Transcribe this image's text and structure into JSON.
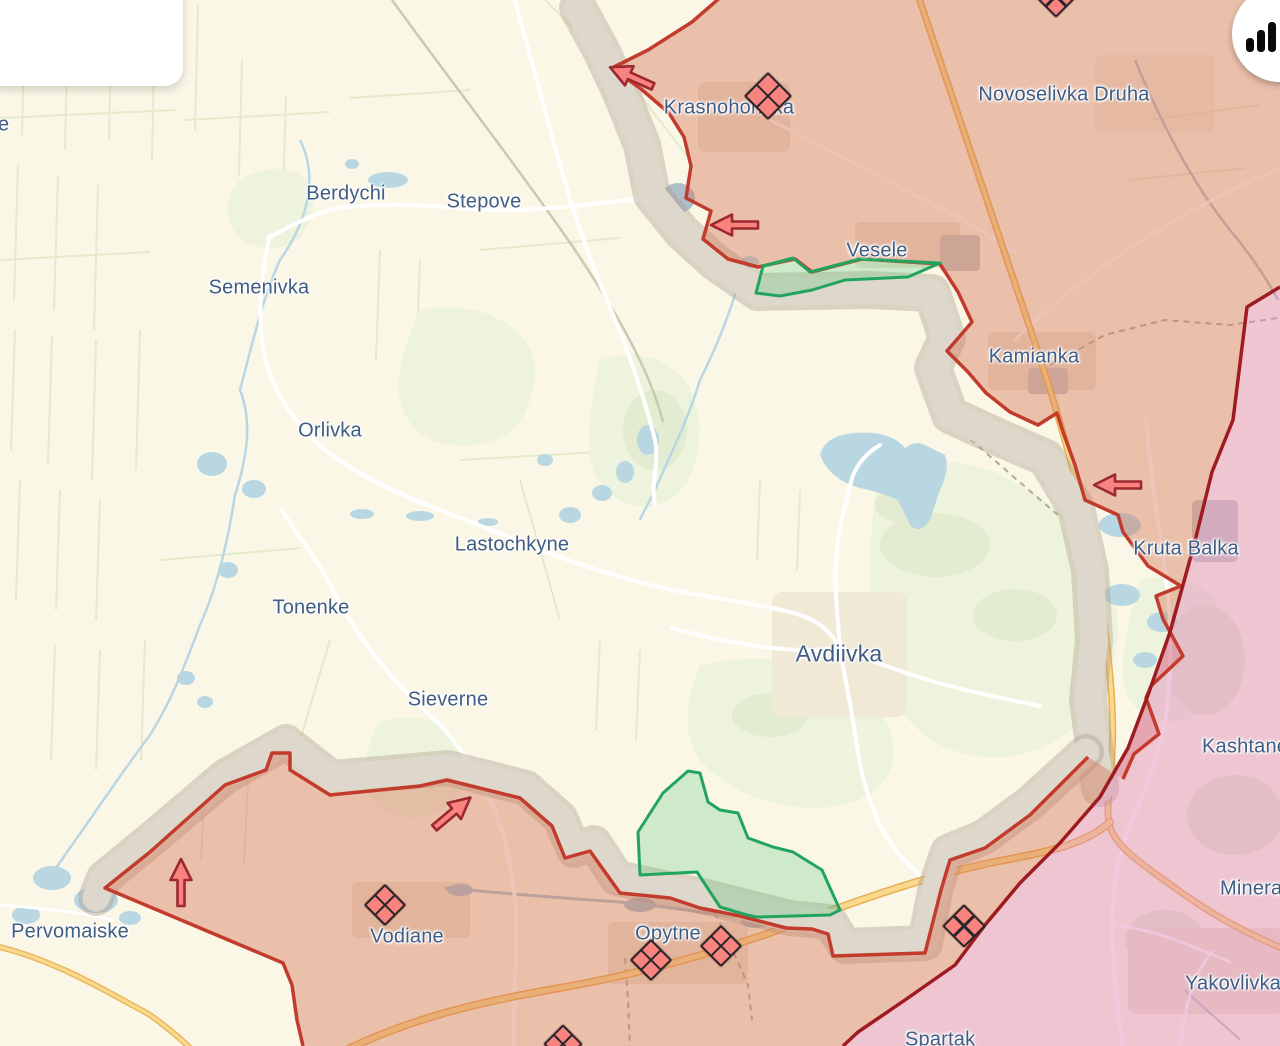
{
  "ui": {
    "info_card": {
      "note": "empty white popup card, content cut off at screen edge"
    },
    "stats_button": {
      "icon": "bar-chart-icon"
    }
  },
  "map": {
    "colors": {
      "background": "#fbf7e7",
      "field_line": "#dce7c1",
      "water": "#b9d7e2",
      "highway": "#f8d98d",
      "highway_casing": "#eaaf52",
      "occupied_fill": "rgba(213,116,88,0.42)",
      "occupied_2014_fill": "rgba(225,135,185,0.45)",
      "grey_zone_fill": "#ded7cb",
      "front_line": "#c23b2c",
      "pre2022_line": "#9e1b22",
      "liberated_stroke": "#21a55e",
      "liberated_fill": "rgba(76,195,119,0.25)",
      "town_label": "#3f5c84",
      "marker_fill": "#f9837e",
      "marker_outline": "#26262a",
      "arrow_outline": "#9c2830"
    },
    "town_labels": [
      {
        "text": "Berdychi",
        "x": 346,
        "y": 194,
        "size": 20
      },
      {
        "text": "Stepove",
        "x": 484,
        "y": 202,
        "size": 20
      },
      {
        "text": "Semenivka",
        "x": 259,
        "y": 288,
        "size": 20
      },
      {
        "text": "Orlivka",
        "x": 330,
        "y": 431,
        "size": 20
      },
      {
        "text": "Lastochkyne",
        "x": 512,
        "y": 545,
        "size": 20
      },
      {
        "text": "Tonenke",
        "x": 311,
        "y": 608,
        "size": 20
      },
      {
        "text": "Sieverne",
        "x": 448,
        "y": 700,
        "size": 20
      },
      {
        "text": "Avdiivka",
        "x": 839,
        "y": 654,
        "size": 23
      },
      {
        "text": "Krasnohorivka",
        "x": 729,
        "y": 108,
        "size": 20
      },
      {
        "text": "Novoselivka Druha",
        "x": 1064,
        "y": 95,
        "size": 20
      },
      {
        "text": "Vesele",
        "x": 877,
        "y": 251,
        "size": 20
      },
      {
        "text": "Kamianka",
        "x": 1034,
        "y": 357,
        "size": 20
      },
      {
        "text": "Kruta Balka",
        "x": 1186,
        "y": 549,
        "size": 20
      },
      {
        "text": "Pervomaiske",
        "x": 70,
        "y": 932,
        "size": 20
      },
      {
        "text": "Vodiane",
        "x": 407,
        "y": 937,
        "size": 20
      },
      {
        "text": "Opytne",
        "x": 668,
        "y": 934,
        "size": 20
      },
      {
        "text": "Kashtane",
        "x": 1202,
        "y": 747,
        "size": 20,
        "align": "left"
      },
      {
        "text": "Mineralne",
        "x": 1220,
        "y": 889,
        "size": 20,
        "align": "left"
      },
      {
        "text": "Yakovlivka",
        "x": 1185,
        "y": 984,
        "size": 20,
        "align": "left"
      },
      {
        "text": "Spartak",
        "x": 905,
        "y": 1040,
        "size": 20,
        "align": "left"
      },
      {
        "text": "e",
        "x": -2,
        "y": 125,
        "size": 20,
        "align": "left"
      }
    ],
    "attack_arrows": [
      {
        "x": 632,
        "y": 77,
        "rotation": -156
      },
      {
        "x": 735,
        "y": 225,
        "rotation": 180
      },
      {
        "x": 1118,
        "y": 485,
        "rotation": 180
      },
      {
        "x": 181,
        "y": 883,
        "rotation": -90
      },
      {
        "x": 452,
        "y": 813,
        "rotation": -40
      }
    ],
    "battle_markers": [
      {
        "x": 768,
        "y": 96,
        "size": 30
      },
      {
        "x": 1056,
        "y": -4,
        "size": 27
      },
      {
        "x": 385,
        "y": 905,
        "size": 26
      },
      {
        "x": 651,
        "y": 960,
        "size": 26
      },
      {
        "x": 721,
        "y": 946,
        "size": 26
      },
      {
        "x": 964,
        "y": 926,
        "size": 27
      },
      {
        "x": 563,
        "y": 1044,
        "size": 24
      }
    ],
    "liberated_areas": [
      {
        "name": "polygon-near-vesele"
      },
      {
        "name": "polygon-south-of-avdiivka"
      }
    ]
  }
}
